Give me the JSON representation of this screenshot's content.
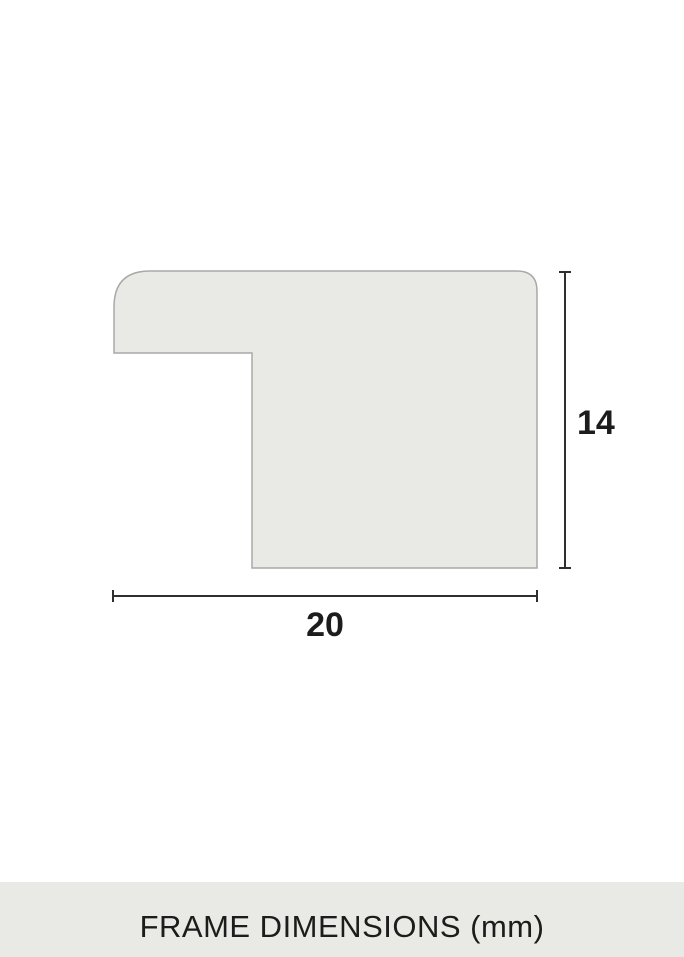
{
  "diagram": {
    "height_dimension_label": "14",
    "width_dimension_label": "20"
  },
  "footer": {
    "caption": "FRAME DIMENSIONS (mm)"
  },
  "colors": {
    "page_background": "#ffffff",
    "shape_fill": "#e9e9e5",
    "shape_stroke": "#a9a9a9",
    "dimension_line": "#2f2f2f",
    "dimension_text": "#1c1c1c",
    "footer_background": "#e9e9e5",
    "footer_text": "#1c1c1c"
  }
}
